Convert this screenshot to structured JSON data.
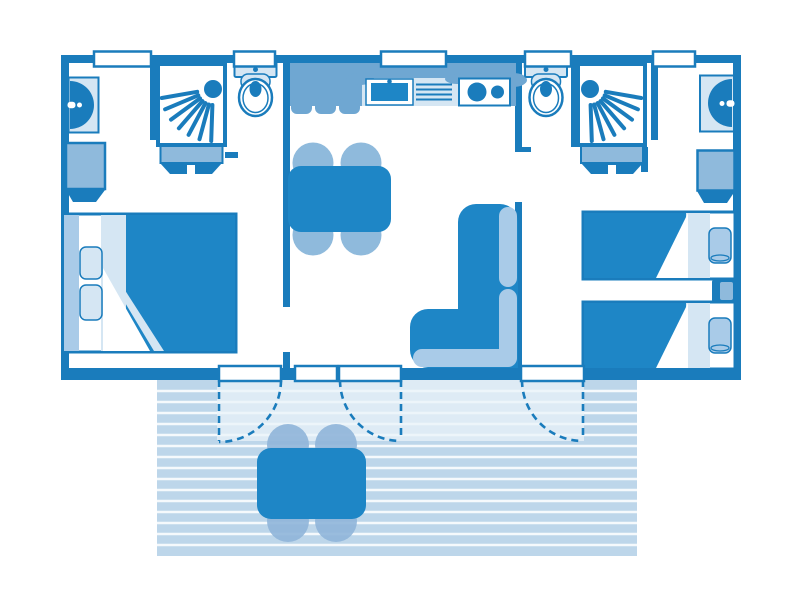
{
  "title": "mobile-home-floor-plan",
  "colors": {
    "dark": "#1A7CBC",
    "furn": "#1E86C6",
    "med": "#6FA7D2",
    "med2": "#8FBADC",
    "cushion": "#A9CBE8",
    "pale": "#D5E6F3",
    "deck": "#BDD6EA",
    "deck_light": "#EAF2F9",
    "deck_line": "#F5F9FC",
    "chair_out": "#8FB5D9",
    "white": "#FFFFFF"
  },
  "legend": {
    "rooms": [
      "bedroom-left",
      "bathroom-left",
      "kitchen-living",
      "bathroom-right",
      "bedroom-right",
      "terrace"
    ],
    "fixtures": [
      "washbasin",
      "shower",
      "toilet",
      "water-heater",
      "wardrobe",
      "double-bed",
      "single-bed",
      "pillow",
      "nightstand",
      "kitchen-counter",
      "kitchen-sink",
      "drainboard",
      "cooktop",
      "dining-table",
      "dining-chair",
      "corner-sofa",
      "terrace-table",
      "terrace-chair",
      "window",
      "door-leaf",
      "door-swing-arc",
      "deck-planks"
    ]
  },
  "counts": {
    "windows_top_wall": 5,
    "door_leaves_bottom_wall": 4,
    "door_swing_arcs": 3,
    "double_beds": 1,
    "single_beds": 2,
    "pillows": 4,
    "toilets": 2,
    "showers": 2,
    "washbasins": 2,
    "wardrobes": 2,
    "water_heaters": 2,
    "dining_chairs": 4,
    "terrace_chairs": 4,
    "cooktop_burners": 2,
    "sofas": 1,
    "nightstands": 1
  }
}
